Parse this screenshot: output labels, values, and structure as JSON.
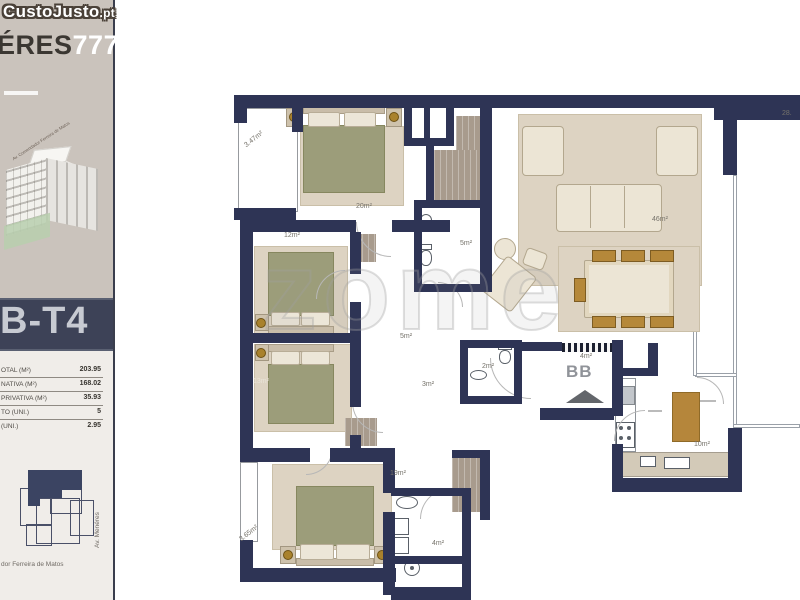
{
  "site_watermark": {
    "name": "CustoJusto",
    "tld": ".pt"
  },
  "sidebar": {
    "project_title_dark": "ÉRES",
    "project_title_accent": "777",
    "unit_code": "B-T4",
    "specs": [
      {
        "label": "OTAL (M²)",
        "value": "203.95"
      },
      {
        "label": "NATIVA (M²)",
        "value": "168.02"
      },
      {
        "label": "PRIVATIVA (M²)",
        "value": "35.93"
      },
      {
        "label": "TO (UNI.)",
        "value": "5"
      },
      {
        "label": "(UNI.)",
        "value": "2.95"
      }
    ],
    "illustration_street_label": "Av. Comendador Ferreira de Matos",
    "map_street_bottom": "dor Ferreira de Matos",
    "map_street_side": "Av. Menéres"
  },
  "floorplan": {
    "watermark": "zome",
    "section_marker": "BB",
    "room_labels": [
      {
        "text": "3.47m²",
        "x": 243,
        "y": 136,
        "rot": -38
      },
      {
        "text": "20m²",
        "x": 356,
        "y": 203
      },
      {
        "text": "12m²",
        "x": 284,
        "y": 232
      },
      {
        "text": "5m²",
        "x": 460,
        "y": 240
      },
      {
        "text": "46m²",
        "x": 652,
        "y": 216
      },
      {
        "text": "28.",
        "x": 782,
        "y": 110
      },
      {
        "text": "5m²",
        "x": 400,
        "y": 333
      },
      {
        "text": "3m²",
        "x": 422,
        "y": 381
      },
      {
        "text": "2m²",
        "x": 482,
        "y": 363
      },
      {
        "text": "4m²",
        "x": 580,
        "y": 353
      },
      {
        "text": "10m²",
        "x": 694,
        "y": 441
      },
      {
        "text": "13m²",
        "x": 253,
        "y": 378,
        "light": true
      },
      {
        "text": "19m²",
        "x": 390,
        "y": 470
      },
      {
        "text": "4m²",
        "x": 432,
        "y": 540
      },
      {
        "text": "3.65m²",
        "x": 238,
        "y": 530,
        "rot": -38
      }
    ]
  },
  "colors": {
    "wall_navy": "#2e3455",
    "band_navy": "#3d4257",
    "sidebar_beige": "#cac3bc",
    "rug_beige": "#ddd3c2",
    "duvet_olive": "#9c9d7a",
    "closet_taupe": "#a89b8d",
    "accent_gold": "#a9822d"
  }
}
